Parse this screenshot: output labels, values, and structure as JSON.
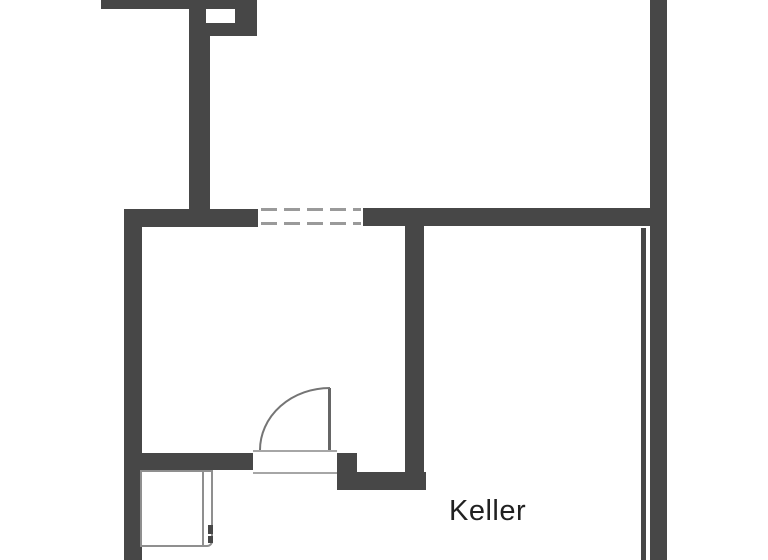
{
  "rooms": {
    "keller": {
      "label": "Keller"
    }
  },
  "colors": {
    "background": "#ffffff",
    "wall": "#474747",
    "window_dash": "#9a9a9a",
    "threshold_line": "#a6a6a6",
    "door_leaf": "#666666",
    "door_arc": "#757575",
    "shaft_outline": "#8f8f8f",
    "label_text": "#212121"
  },
  "plan": {
    "width": 768,
    "height": 560,
    "walls": [
      {
        "name": "wall-top-bar",
        "x": 101,
        "y": 0,
        "w": 156,
        "h": 9
      },
      {
        "name": "chimney-block",
        "x": 189,
        "y": 0,
        "w": 68,
        "h": 36
      },
      {
        "name": "wall-upper-vertical",
        "x": 189,
        "y": 9,
        "w": 21,
        "h": 216
      },
      {
        "name": "wall-mid-horizontal-left",
        "x": 124,
        "y": 209,
        "w": 134,
        "h": 18
      },
      {
        "name": "wall-mid-horizontal-right",
        "x": 363,
        "y": 208,
        "w": 289,
        "h": 18
      },
      {
        "name": "wall-right-exterior",
        "x": 650,
        "y": 0,
        "w": 17,
        "h": 560
      },
      {
        "name": "wall-right-inner-line",
        "x": 641,
        "y": 228,
        "w": 5,
        "h": 332
      },
      {
        "name": "wall-left-exterior",
        "x": 124,
        "y": 209,
        "w": 18,
        "h": 351
      },
      {
        "name": "wall-keller-vertical",
        "x": 405,
        "y": 225,
        "w": 19,
        "h": 265
      },
      {
        "name": "wall-room-bottom",
        "x": 124,
        "y": 453,
        "w": 129,
        "h": 17
      },
      {
        "name": "wall-door-jamb",
        "x": 337,
        "y": 453,
        "w": 20,
        "h": 37
      },
      {
        "name": "wall-lower-bar",
        "x": 337,
        "y": 472,
        "w": 89,
        "h": 18
      }
    ],
    "cutouts": [
      {
        "name": "chimney-flue-opening",
        "x": 206,
        "y": 9,
        "w": 29,
        "h": 14
      }
    ],
    "window": {
      "name": "window-symbol",
      "area": {
        "x": 258,
        "y": 206,
        "w": 105,
        "h": 22
      },
      "lines": [
        {
          "x": 261,
          "y": 208,
          "w": 100,
          "h": 3
        },
        {
          "x": 261,
          "y": 222,
          "w": 100,
          "h": 3
        }
      ]
    },
    "door": {
      "threshold": {
        "x": 253,
        "y": 450,
        "w": 84,
        "h": 24
      },
      "leaf": {
        "x": 328,
        "y": 388,
        "w": 3,
        "h": 62
      },
      "arc": {
        "from_x": 330,
        "from_y": 388,
        "rx": 70,
        "ry": 62,
        "to_x": 260,
        "to_y": 450,
        "stroke_w": 2
      }
    },
    "shaft": {
      "box": {
        "x": 140,
        "y": 470,
        "w": 73,
        "h": 77
      },
      "inner_line": {
        "x": 202,
        "y": 470,
        "w": 2,
        "h": 76
      },
      "marks": [
        {
          "x": 208,
          "y": 525,
          "w": 5,
          "h": 9
        },
        {
          "x": 208,
          "y": 536,
          "w": 5,
          "h": 7
        }
      ]
    },
    "label_pos": {
      "x": 449,
      "y": 497
    }
  }
}
